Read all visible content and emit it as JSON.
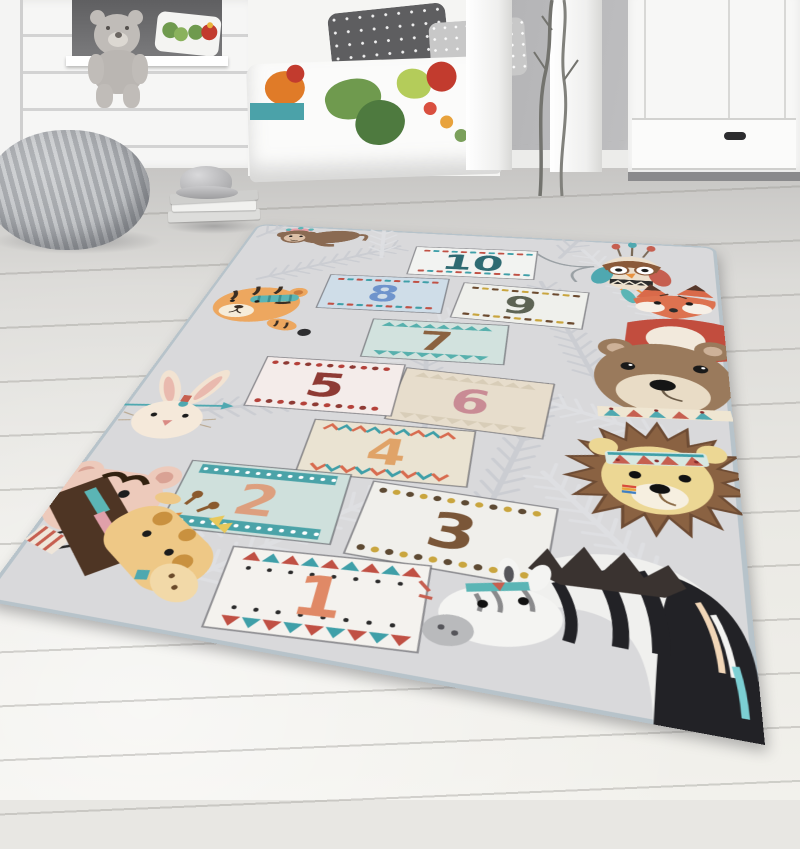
{
  "scene": {
    "type": "product photo",
    "subject": "kids hopscotch play rug with tribal animals in a nursery",
    "room_items": [
      "house-bed",
      "teddy-bear",
      "bed-with-printed-duvet",
      "polka-dot-pillows",
      "white-wardrobe",
      "decor-branches",
      "knitted-pouf",
      "book-stack",
      "silver-cap",
      "wood-floor"
    ]
  },
  "palette": {
    "wall": "#a8a8aa",
    "furniture_white": "#f6f6f5",
    "floor": "#eae9e4",
    "rug_base": "#d9d9db",
    "rug_binding": "#b7c3ca",
    "leaf_gray": "#c9cbd1",
    "pouf_gray": "#b0b3b6",
    "accent_teal": "#4ba2a9"
  },
  "rug": {
    "squares": [
      {
        "number": "1",
        "bg": "#f4f2ee",
        "num_color": "#e08966",
        "border_style": "tri-dots",
        "border_colors": [
          "#c05044",
          "#3f9fa8",
          "#2b2b2b"
        ]
      },
      {
        "number": "2",
        "bg": "#cfe0dc",
        "num_color": "#dd9f7e",
        "border_style": "band-dots",
        "border_colors": [
          "#4ba3a8",
          "#ffffff"
        ]
      },
      {
        "number": "3",
        "bg": "#f0efeb",
        "num_color": "#7a5638",
        "border_style": "dots",
        "border_colors": [
          "#5e4a33",
          "#c9a53e"
        ]
      },
      {
        "number": "4",
        "bg": "#eae3d2",
        "num_color": "#e0a368",
        "border_style": "chevron",
        "border_colors": [
          "#d86b4f",
          "#3f9fa8"
        ]
      },
      {
        "number": "5",
        "bg": "#f4ecea",
        "num_color": "#8e3a34",
        "border_style": "dots",
        "border_colors": [
          "#b5413a",
          "#8e3a34"
        ]
      },
      {
        "number": "6",
        "bg": "#e7ddcc",
        "num_color": "#c98b95",
        "border_style": "zigzag",
        "border_colors": [
          "#d8cdb8"
        ]
      },
      {
        "number": "7",
        "bg": "#d2e2de",
        "num_color": "#8a6240",
        "border_style": "zigzag",
        "border_colors": [
          "#57b0ad"
        ]
      },
      {
        "number": "8",
        "bg": "#cfdde8",
        "num_color": "#6f94cc",
        "border_style": "dash",
        "border_colors": [
          "#c05044",
          "#3f9fa8"
        ]
      },
      {
        "number": "9",
        "bg": "#eff0ec",
        "num_color": "#5d6354",
        "border_style": "dash",
        "border_colors": [
          "#6b4a2f",
          "#c9a53e"
        ]
      },
      {
        "number": "10",
        "bg": "#f2f3f1",
        "num_color": "#2e6a72",
        "border_style": "dash",
        "border_colors": [
          "#c05044",
          "#3f9fa8"
        ]
      }
    ],
    "animals": [
      "monkey",
      "tiger",
      "rabbit",
      "bear-cub",
      "giraffe",
      "owl",
      "fox",
      "bear",
      "lion",
      "zebra"
    ]
  }
}
